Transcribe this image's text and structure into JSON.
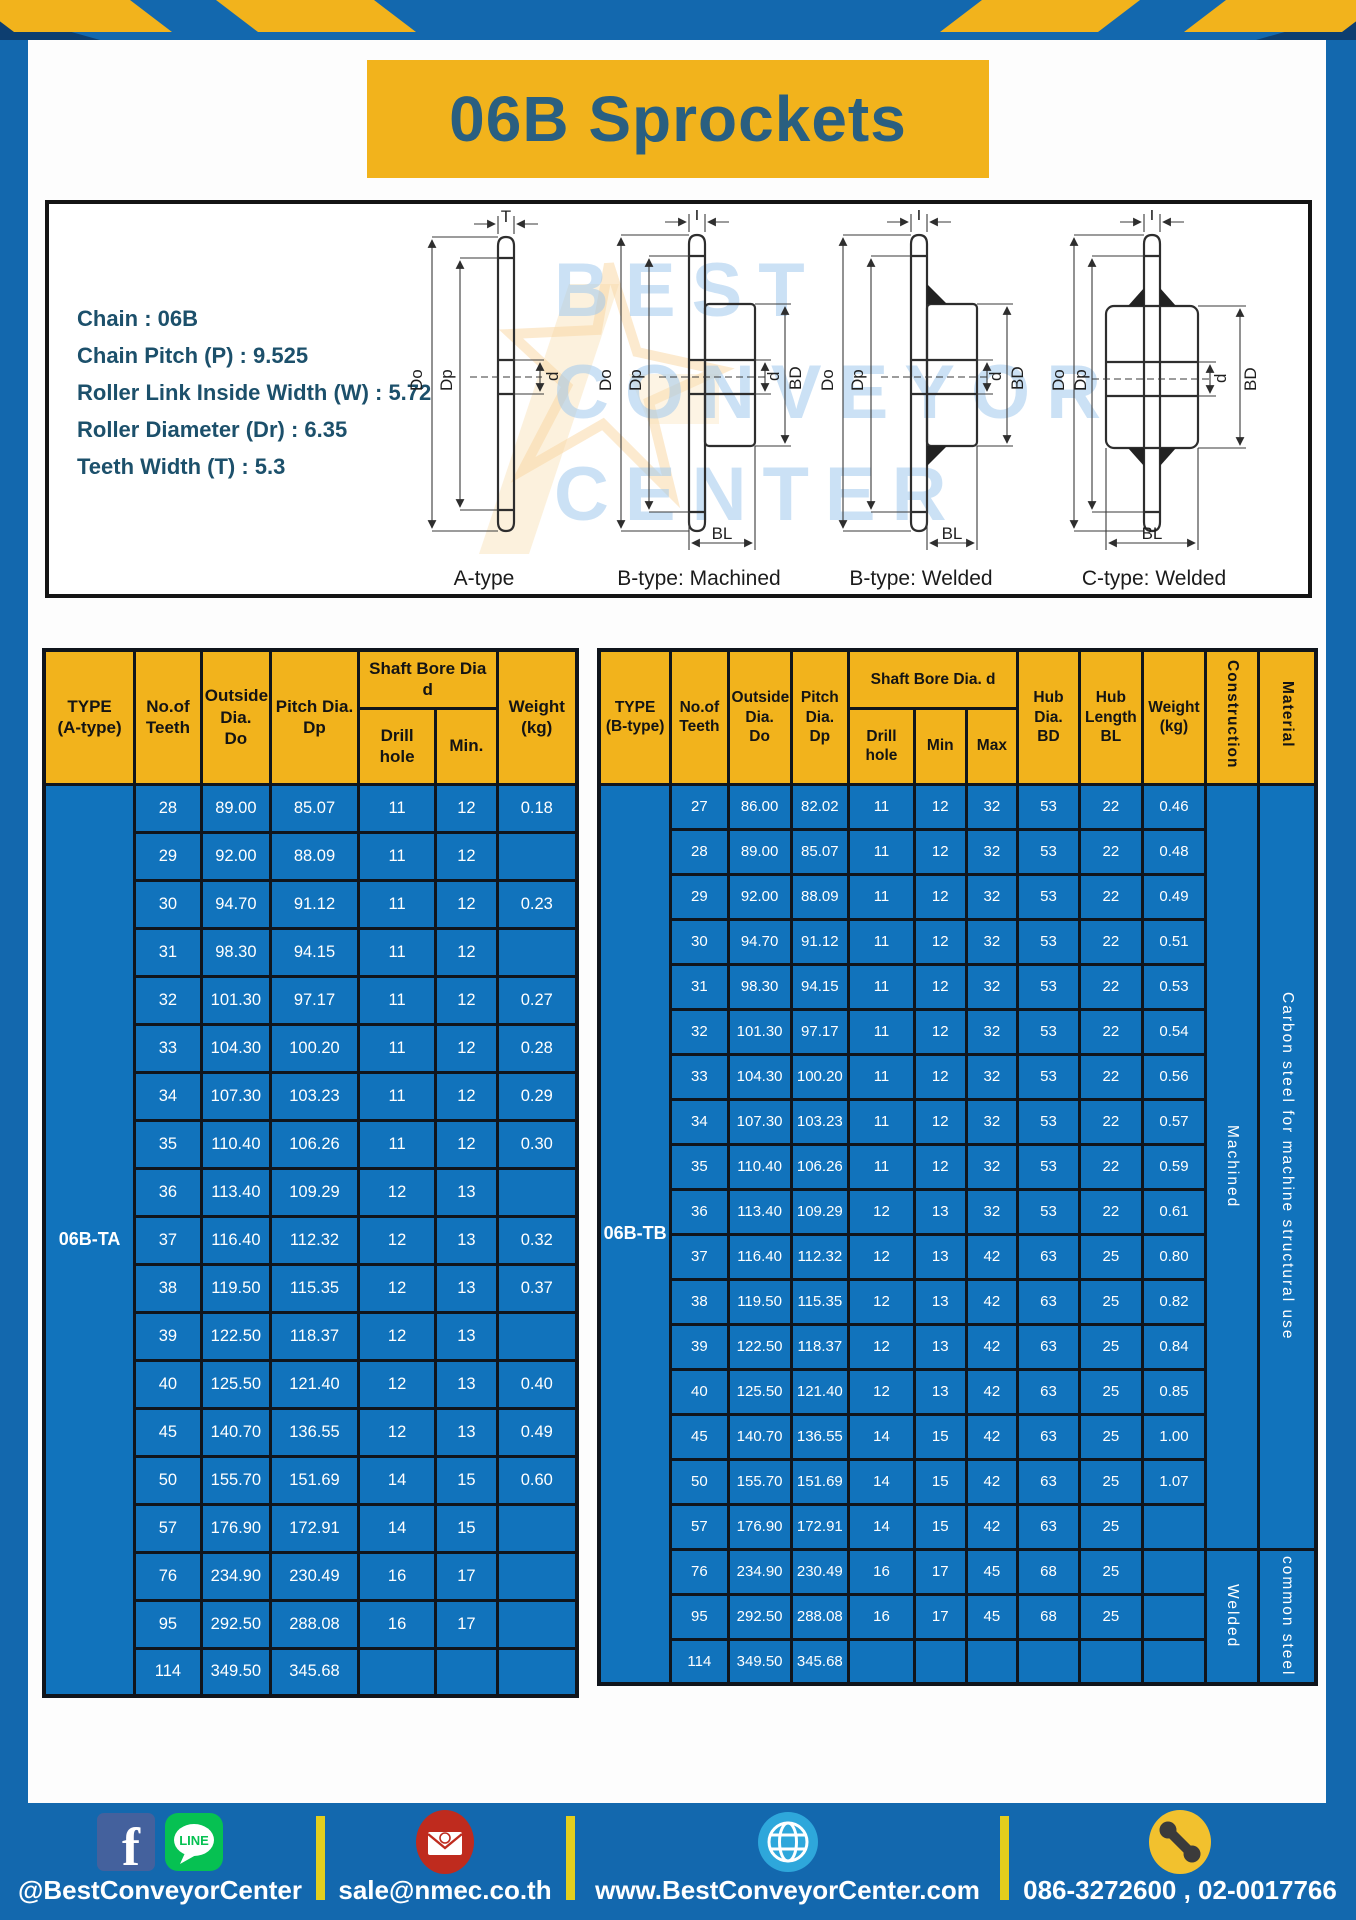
{
  "title": "06B Sprockets",
  "specs": {
    "lines": [
      "Chain : 06B",
      "Chain Pitch (P) : 9.525",
      "Roller Link Inside Width (W) : 5.72",
      "Roller Diameter (Dr) : 6.35",
      "Teeth Width (T) : 5.3"
    ]
  },
  "watermark": {
    "line1": "BEST",
    "line2": "CONVEYOR",
    "line3": "CENTER"
  },
  "diagrams": [
    {
      "caption": "A-type",
      "labels": {
        "t": "T",
        "outside": "Do",
        "pitch": "Dp",
        "bore": "d"
      }
    },
    {
      "caption": "B-type: Machined",
      "labels": {
        "t": "T",
        "outside": "Do",
        "pitch": "Dp",
        "bore": "d",
        "hub_dia": "BD",
        "hub_len": "BL"
      }
    },
    {
      "caption": "B-type: Welded",
      "labels": {
        "t": "T",
        "outside": "Do",
        "pitch": "Dp",
        "bore": "d",
        "hub_dia": "BD",
        "hub_len": "BL"
      }
    },
    {
      "caption": "C-type: Welded",
      "labels": {
        "t": "T",
        "outside": "Do",
        "pitch": "Dp",
        "bore": "d",
        "hub_dia": "BD",
        "hub_len": "BL"
      }
    }
  ],
  "table_a": {
    "headers": {
      "type": "TYPE\n(A-type)",
      "teeth": "No.of\nTeeth",
      "outside": "Outside\nDia.\nDo",
      "pitch": "Pitch Dia.\nDp",
      "shaft_bore": "Shaft Bore Dia d",
      "drill": "Drill hole",
      "min": "Min.",
      "weight": "Weight\n(kg)"
    },
    "type_label": "06B-TA",
    "rows": [
      [
        "28",
        "89.00",
        "85.07",
        "11",
        "12",
        "0.18"
      ],
      [
        "29",
        "92.00",
        "88.09",
        "11",
        "12",
        ""
      ],
      [
        "30",
        "94.70",
        "91.12",
        "11",
        "12",
        "0.23"
      ],
      [
        "31",
        "98.30",
        "94.15",
        "11",
        "12",
        ""
      ],
      [
        "32",
        "101.30",
        "97.17",
        "11",
        "12",
        "0.27"
      ],
      [
        "33",
        "104.30",
        "100.20",
        "11",
        "12",
        "0.28"
      ],
      [
        "34",
        "107.30",
        "103.23",
        "11",
        "12",
        "0.29"
      ],
      [
        "35",
        "110.40",
        "106.26",
        "11",
        "12",
        "0.30"
      ],
      [
        "36",
        "113.40",
        "109.29",
        "12",
        "13",
        ""
      ],
      [
        "37",
        "116.40",
        "112.32",
        "12",
        "13",
        "0.32"
      ],
      [
        "38",
        "119.50",
        "115.35",
        "12",
        "13",
        "0.37"
      ],
      [
        "39",
        "122.50",
        "118.37",
        "12",
        "13",
        ""
      ],
      [
        "40",
        "125.50",
        "121.40",
        "12",
        "13",
        "0.40"
      ],
      [
        "45",
        "140.70",
        "136.55",
        "12",
        "13",
        "0.49"
      ],
      [
        "50",
        "155.70",
        "151.69",
        "14",
        "15",
        "0.60"
      ],
      [
        "57",
        "176.90",
        "172.91",
        "14",
        "15",
        ""
      ],
      [
        "76",
        "234.90",
        "230.49",
        "16",
        "17",
        ""
      ],
      [
        "95",
        "292.50",
        "288.08",
        "16",
        "17",
        ""
      ],
      [
        "114",
        "349.50",
        "345.68",
        "",
        "",
        ""
      ]
    ]
  },
  "table_b": {
    "headers": {
      "type": "TYPE\n(B-type)",
      "teeth": "No.of\nTeeth",
      "outside": "Outside\nDia.\nDo",
      "pitch": "Pitch\nDia.\nDp",
      "shaft_bore": "Shaft Bore Dia. d",
      "drill": "Drill hole",
      "min": "Min",
      "max": "Max",
      "hub_dia": "Hub\nDia.\nBD",
      "hub_len": "Hub\nLength\nBL",
      "weight": "Weight\n(kg)",
      "construction": "Construction",
      "material": "Material"
    },
    "type_label": "06B-TB",
    "construction": [
      {
        "label": "Machined",
        "span": 17
      },
      {
        "label": "Welded",
        "span": 3
      }
    ],
    "material": [
      {
        "label": "Carbon steel for machine structural use",
        "span": 17
      },
      {
        "label": "common steel",
        "span": 3
      }
    ],
    "rows": [
      [
        "27",
        "86.00",
        "82.02",
        "11",
        "12",
        "32",
        "53",
        "22",
        "0.46"
      ],
      [
        "28",
        "89.00",
        "85.07",
        "11",
        "12",
        "32",
        "53",
        "22",
        "0.48"
      ],
      [
        "29",
        "92.00",
        "88.09",
        "11",
        "12",
        "32",
        "53",
        "22",
        "0.49"
      ],
      [
        "30",
        "94.70",
        "91.12",
        "11",
        "12",
        "32",
        "53",
        "22",
        "0.51"
      ],
      [
        "31",
        "98.30",
        "94.15",
        "11",
        "12",
        "32",
        "53",
        "22",
        "0.53"
      ],
      [
        "32",
        "101.30",
        "97.17",
        "11",
        "12",
        "32",
        "53",
        "22",
        "0.54"
      ],
      [
        "33",
        "104.30",
        "100.20",
        "11",
        "12",
        "32",
        "53",
        "22",
        "0.56"
      ],
      [
        "34",
        "107.30",
        "103.23",
        "11",
        "12",
        "32",
        "53",
        "22",
        "0.57"
      ],
      [
        "35",
        "110.40",
        "106.26",
        "11",
        "12",
        "32",
        "53",
        "22",
        "0.59"
      ],
      [
        "36",
        "113.40",
        "109.29",
        "12",
        "13",
        "32",
        "53",
        "22",
        "0.61"
      ],
      [
        "37",
        "116.40",
        "112.32",
        "12",
        "13",
        "42",
        "63",
        "25",
        "0.80"
      ],
      [
        "38",
        "119.50",
        "115.35",
        "12",
        "13",
        "42",
        "63",
        "25",
        "0.82"
      ],
      [
        "39",
        "122.50",
        "118.37",
        "12",
        "13",
        "42",
        "63",
        "25",
        "0.84"
      ],
      [
        "40",
        "125.50",
        "121.40",
        "12",
        "13",
        "42",
        "63",
        "25",
        "0.85"
      ],
      [
        "45",
        "140.70",
        "136.55",
        "14",
        "15",
        "42",
        "63",
        "25",
        "1.00"
      ],
      [
        "50",
        "155.70",
        "151.69",
        "14",
        "15",
        "42",
        "63",
        "25",
        "1.07"
      ],
      [
        "57",
        "176.90",
        "172.91",
        "14",
        "15",
        "42",
        "63",
        "25",
        ""
      ],
      [
        "76",
        "234.90",
        "230.49",
        "16",
        "17",
        "45",
        "68",
        "25",
        ""
      ],
      [
        "95",
        "292.50",
        "288.08",
        "16",
        "17",
        "45",
        "68",
        "25",
        ""
      ],
      [
        "114",
        "349.50",
        "345.68",
        "",
        "",
        "",
        "",
        "",
        ""
      ]
    ]
  },
  "footer": {
    "line_badge": "LINE",
    "sections": [
      {
        "icons": [
          "facebook-icon",
          "line-icon"
        ],
        "text": "@BestConveyorCenter"
      },
      {
        "icons": [
          "email-icon"
        ],
        "text": "sale@nmec.co.th"
      },
      {
        "icons": [
          "globe-icon"
        ],
        "text": "www.BestConveyorCenter.com"
      },
      {
        "icons": [
          "phone-icon"
        ],
        "text": "086-3272600 , 02-0017766"
      }
    ]
  },
  "colors": {
    "frame_blue": "#1368ae",
    "cell_blue": "#1173bc",
    "accent_yellow": "#f2b31c",
    "divider_yellow": "#e3ce1d",
    "title_text": "#2a5f80"
  }
}
